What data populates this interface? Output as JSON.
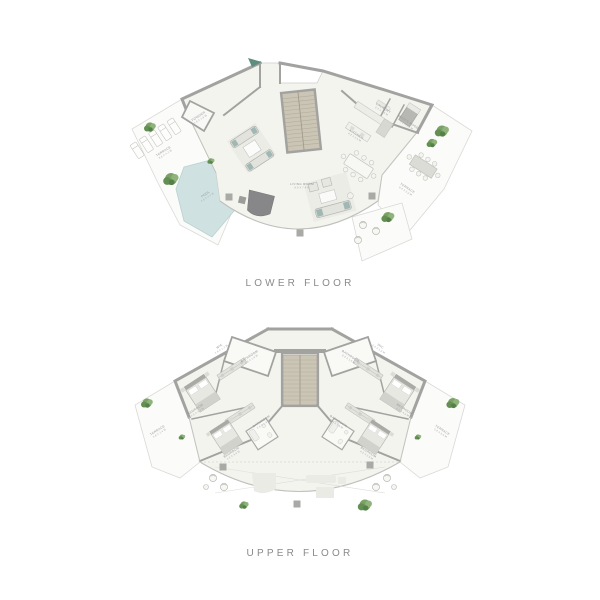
{
  "colors": {
    "wall": "#a2a2a0",
    "floor": "#f4f4ef",
    "terrace": "#fbfbf9",
    "pool": "#cfe2e1",
    "stair": "#cbc5b5",
    "tree_green": "#7ba266",
    "entry_arrow": "#5f8d7f",
    "accent_teal": "#9fb8b4",
    "label_text": "#95959a",
    "title_text": "#8a8a8a"
  },
  "lower": {
    "title": "LOWER FLOOR",
    "rooms": {
      "terrace_left": {
        "name": "TERRACE",
        "dims": "8.6 X 4.2 M"
      },
      "powder": {
        "name": "POWDER",
        "dims": "1.9 X 1.6 M"
      },
      "pool": {
        "name": "POOL",
        "dims": "4.6 X 4.2 M"
      },
      "living": {
        "name": "LIVING ROOM",
        "dims": "8.9 X 7.4 M"
      },
      "kitchen": {
        "name": "KITCHEN",
        "dims": "4.2 X 3.4 M"
      },
      "laundry": {
        "name": "LAUNDRY",
        "dims": "2.3 X 1.8 M"
      },
      "maid": {
        "name": "MAID'S ROOM",
        "dims": "3.1 X 2.6 M"
      },
      "terrace_right": {
        "name": "TERRACE",
        "dims": "6.4 X 3.2 M"
      }
    }
  },
  "upper": {
    "title": "UPPER FLOOR",
    "rooms": {
      "bathroom_tl": {
        "name": "BATHROOM",
        "dims": "2.9 X 1.8 M"
      },
      "bathroom_tr": {
        "name": "BATHROOM",
        "dims": "2.9 X 1.8 M"
      },
      "wic_l": {
        "name": "WIC",
        "dims": "2.9 X 1.2 M"
      },
      "wic_r": {
        "name": "WIC",
        "dims": "2.9 X 1.2 M"
      },
      "bedroom_1": {
        "name": "BEDROOM",
        "dims": "4.5 X 4.2 M"
      },
      "bedroom_2": {
        "name": "BEDROOM",
        "dims": "4.2 X 3.9 M"
      },
      "bedroom_3": {
        "name": "BEDROOM",
        "dims": "4.5 X 4.2 M"
      },
      "bedroom_4": {
        "name": "BEDROOM",
        "dims": "4.2 X 3.9 M"
      },
      "bathroom_ml": {
        "name": "BATHROOM",
        "dims": "2.6 X 1.9 M"
      },
      "bathroom_mr": {
        "name": "BATHROOM",
        "dims": "2.6 X 1.9 M"
      },
      "terrace_l": {
        "name": "TERRACE",
        "dims": "5.8 X 2.4 M"
      },
      "terrace_r": {
        "name": "TERRACE",
        "dims": "5.8 X 2.4 M"
      }
    }
  }
}
